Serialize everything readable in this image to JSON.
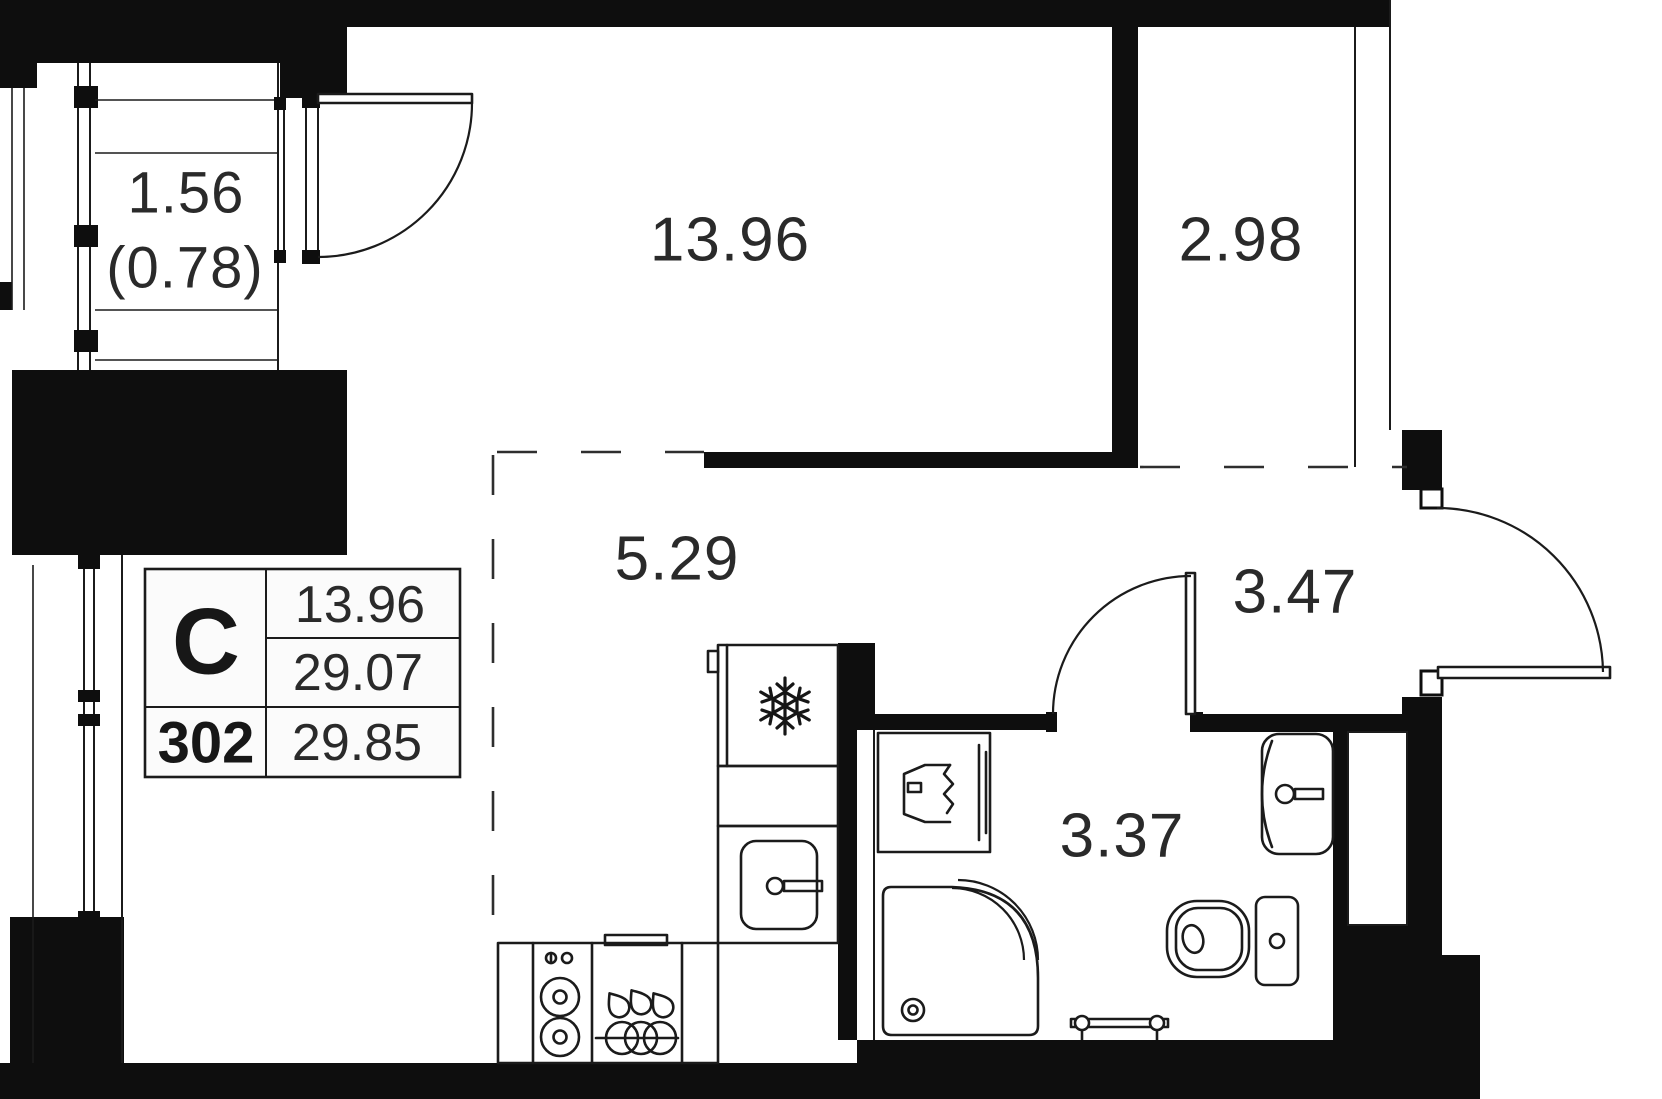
{
  "floorplan": {
    "unit_card": {
      "type_label": "С",
      "unit_number": "302",
      "room_area": "13.96",
      "living_area": "29.07",
      "total_area": "29.85"
    },
    "rooms": {
      "living_room": {
        "area_label": "13.96"
      },
      "niche": {
        "area_label": "2.98"
      },
      "kitchen": {
        "area_label": "5.29"
      },
      "hallway": {
        "area_label": "3.47"
      },
      "bathroom": {
        "area_label": "3.37"
      },
      "balcony": {
        "area_label": "1.56",
        "reduced_area_label": "(0.78)"
      }
    },
    "icons": [
      "snowflake-icon",
      "stove-burners-icon",
      "dish-rack-icon",
      "kitchen-sink-icon",
      "washing-machine-icon",
      "shower-icon",
      "toilet-icon",
      "bathroom-sink-icon",
      "towel-rail-icon"
    ],
    "colors": {
      "walls": "#0e0e0e",
      "lines": "#1b1b1b",
      "text": "#2a2a2a",
      "background": "#ffffff"
    }
  }
}
